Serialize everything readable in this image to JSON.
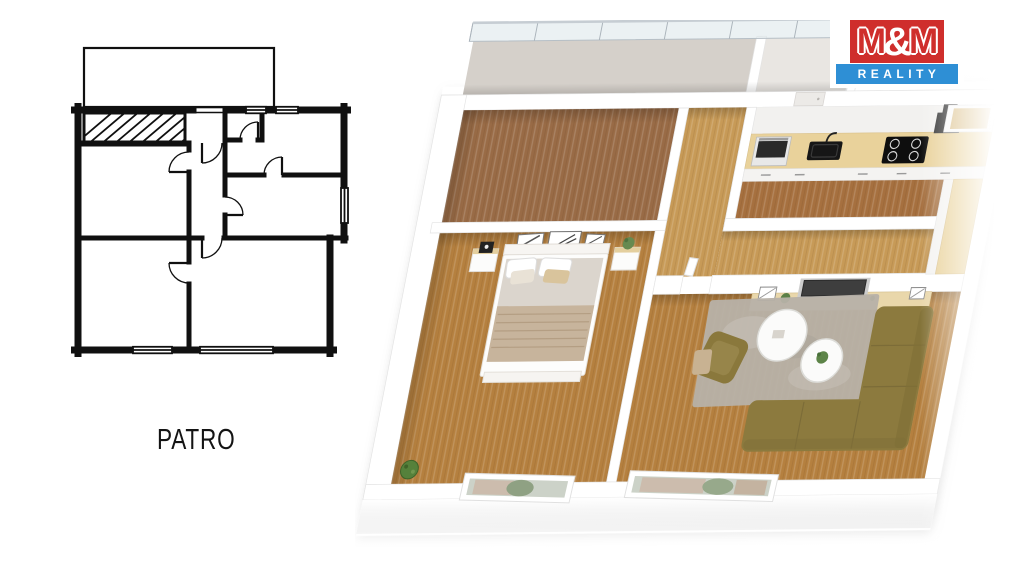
{
  "floor_label": "PATRO",
  "logo": {
    "m1": "M",
    "amp": "&",
    "m2": "M",
    "reality": "REALITY"
  },
  "colors": {
    "logo_red": "#cf2e2c",
    "logo_blue": "#2e8fd5",
    "plan_ink": "#101010",
    "wood_dark": "#996b46",
    "wood_gold": "#b5803f",
    "wood_hall": "#c79a57",
    "wood_kitchen": "#a6703f",
    "wood_counter": "#e9d29b",
    "wood_sideboard": "#e9d7ab",
    "sofa_olive": "#8c7a3e",
    "rug_gray": "#b7b1a8",
    "glass_rail": "#dfe8ec",
    "terrace_floor": "#d5d0ca",
    "shrub_green": "#55813b",
    "wall_edge": "#e3e3e3"
  }
}
